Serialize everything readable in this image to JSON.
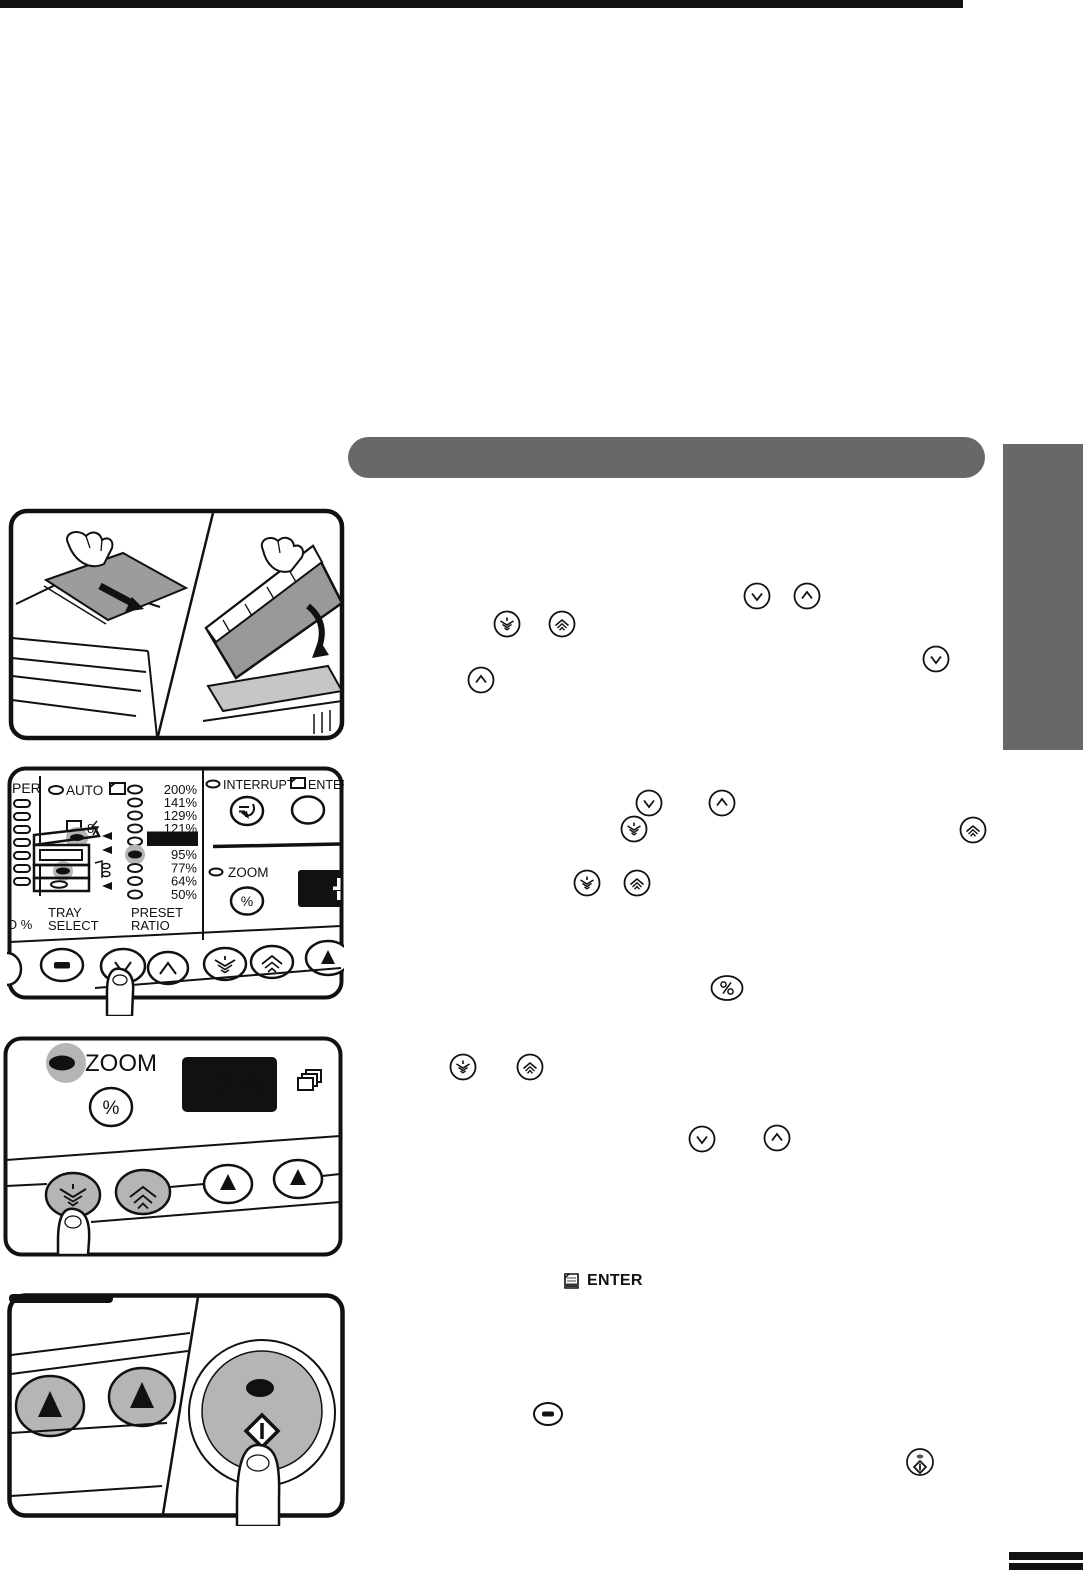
{
  "page": {
    "background": "#ffffff",
    "top_rule_color": "#111111",
    "section_header_color": "#686868",
    "side_tab_color": "#686868",
    "highlight_gray": "#b5b5b5"
  },
  "panels": {
    "control_panel": {
      "paper_label_partial": "PER",
      "auto_label": "AUTO",
      "misfeed_digit": "8",
      "preset_ratios": [
        "200%",
        "141%",
        "129%",
        "121%",
        "100%",
        "95%",
        "77%",
        "64%",
        "50%"
      ],
      "highlighted_ratio": "100%",
      "lit_ratio_led": "95%",
      "tray_select_line1": "TRAY",
      "tray_select_line2": "SELECT",
      "preset_ratio_line1": "PRESET",
      "preset_ratio_line2": "RATIO",
      "zoom_scale_partial": "O %",
      "interrupt_label": "INTERRUPT",
      "enter_label": "ENTER",
      "zoom_label": "ZOOM",
      "percent_label": "%"
    },
    "zoom_panel": {
      "zoom_label": "ZOOM",
      "percent_label": "%",
      "display_value": "94"
    }
  },
  "inline": {
    "enter_label": "ENTER"
  },
  "icons": {
    "down-arrow-key-icon": "circle with down chevron",
    "up-arrow-key-icon": "circle with up chevron",
    "zoom-down-key-icon": "circle with nested down chevrons",
    "zoom-up-key-icon": "circle with nested up chevrons",
    "percent-key-icon": "oval with percent sign",
    "clear-key-icon": "oval with solid bar",
    "start-key-icon": "circle with diamond start mark",
    "enter-page-icon": "small document page",
    "copies-icon": "stacked pages"
  }
}
